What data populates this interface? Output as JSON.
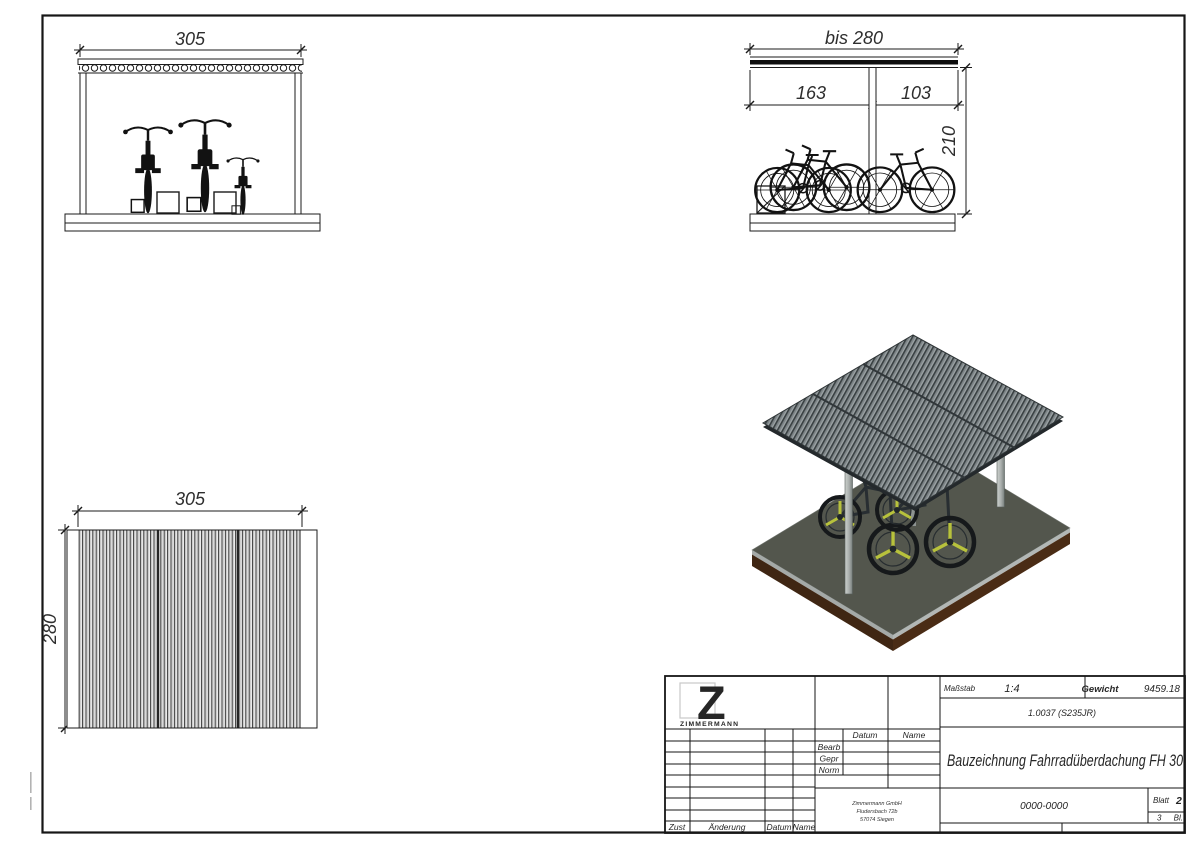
{
  "drawing": {
    "front_view": {
      "dim_width": "305"
    },
    "side_view": {
      "dim_total": "bis 280",
      "dim_left": "163",
      "dim_right": "103",
      "dim_height": "210"
    },
    "top_view": {
      "dim_width": "305",
      "dim_depth": "280"
    }
  },
  "title_block": {
    "logo": {
      "letter": "Z",
      "company": "ZIMMERMANN",
      "color": "#1d3fa8"
    },
    "scale_label": "Maßstab",
    "scale_value": "1:4",
    "weight_label": "Gewicht",
    "weight_value": "9459.18",
    "material": "1.0037 (S235JR)",
    "title": "Bauzeichnung Fahrradüberdachung FH 30",
    "drawing_number": "0000-0000",
    "sheet_label": "Blatt",
    "sheet_number": "2",
    "sheet_total": "3",
    "sheet_total_label": "Bl.",
    "header_datum": "Datum",
    "header_name": "Name",
    "row_bearb": "Bearb",
    "row_gepr": "Gepr",
    "row_norm": "Norm",
    "address_line1": "Zimmermann GmbH",
    "address_line2": "Fludersbach 72b",
    "address_line3": "57074 Siegen",
    "rev_zust": "Zust",
    "rev_aenderung": "Änderung",
    "rev_datum": "Datum",
    "rev_name": "Name"
  },
  "colors": {
    "line": "#1b1b1b",
    "logo_blue": "#1d3fa8",
    "roof_gray": "#7d8487",
    "roof_ridge_dark": "#394042",
    "base_gray": "#53564d",
    "base_edge_brown": "#44280f",
    "wheel_spoke_yellow": "#b8c23c",
    "post_gray": "#b9bdbb"
  }
}
